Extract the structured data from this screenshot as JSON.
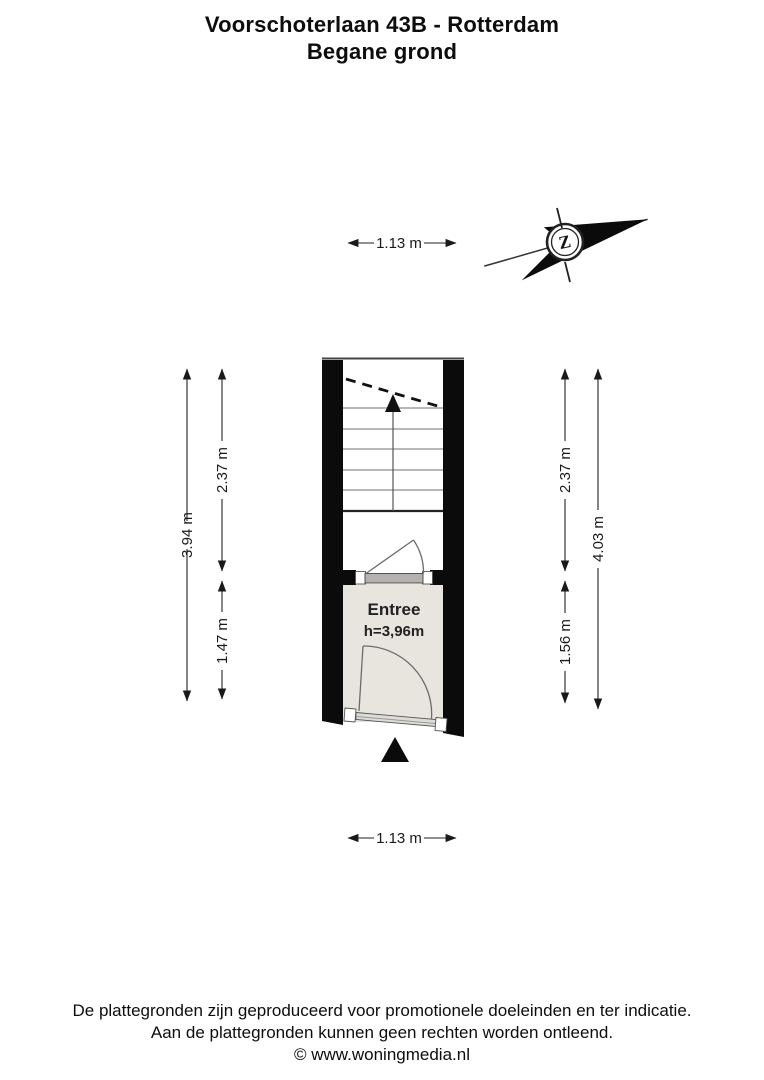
{
  "title": {
    "line1": "Voorschoterlaan 43B - Rotterdam",
    "line2": "Begane grond"
  },
  "compass": {
    "letter": "Z"
  },
  "floorplan": {
    "room": {
      "name": "Entree",
      "height_label": "h=3,96m"
    }
  },
  "dimensions": {
    "top_width": "1.13 m",
    "bottom_width": "1.13 m",
    "left_total": "3.94 m",
    "left_upper": "2.37 m",
    "left_lower": "1.47 m",
    "right_upper": "2.37 m",
    "right_lower": "1.56 m",
    "right_total": "4.03 m"
  },
  "footer": {
    "line1": "De plattegronden zijn geproduceerd voor promotionele doeleinden en ter indicatie.",
    "line2": "Aan de plattegronden kunnen geen rechten worden ontleend.",
    "line3": "© www.woningmedia.nl"
  },
  "colors": {
    "wall": "#0b0b0b",
    "room_fill": "#e8e5df",
    "threshold_fill": "#b4b2ae",
    "stair_line": "#8c8c8c",
    "dimension": "#1a1a1a"
  }
}
